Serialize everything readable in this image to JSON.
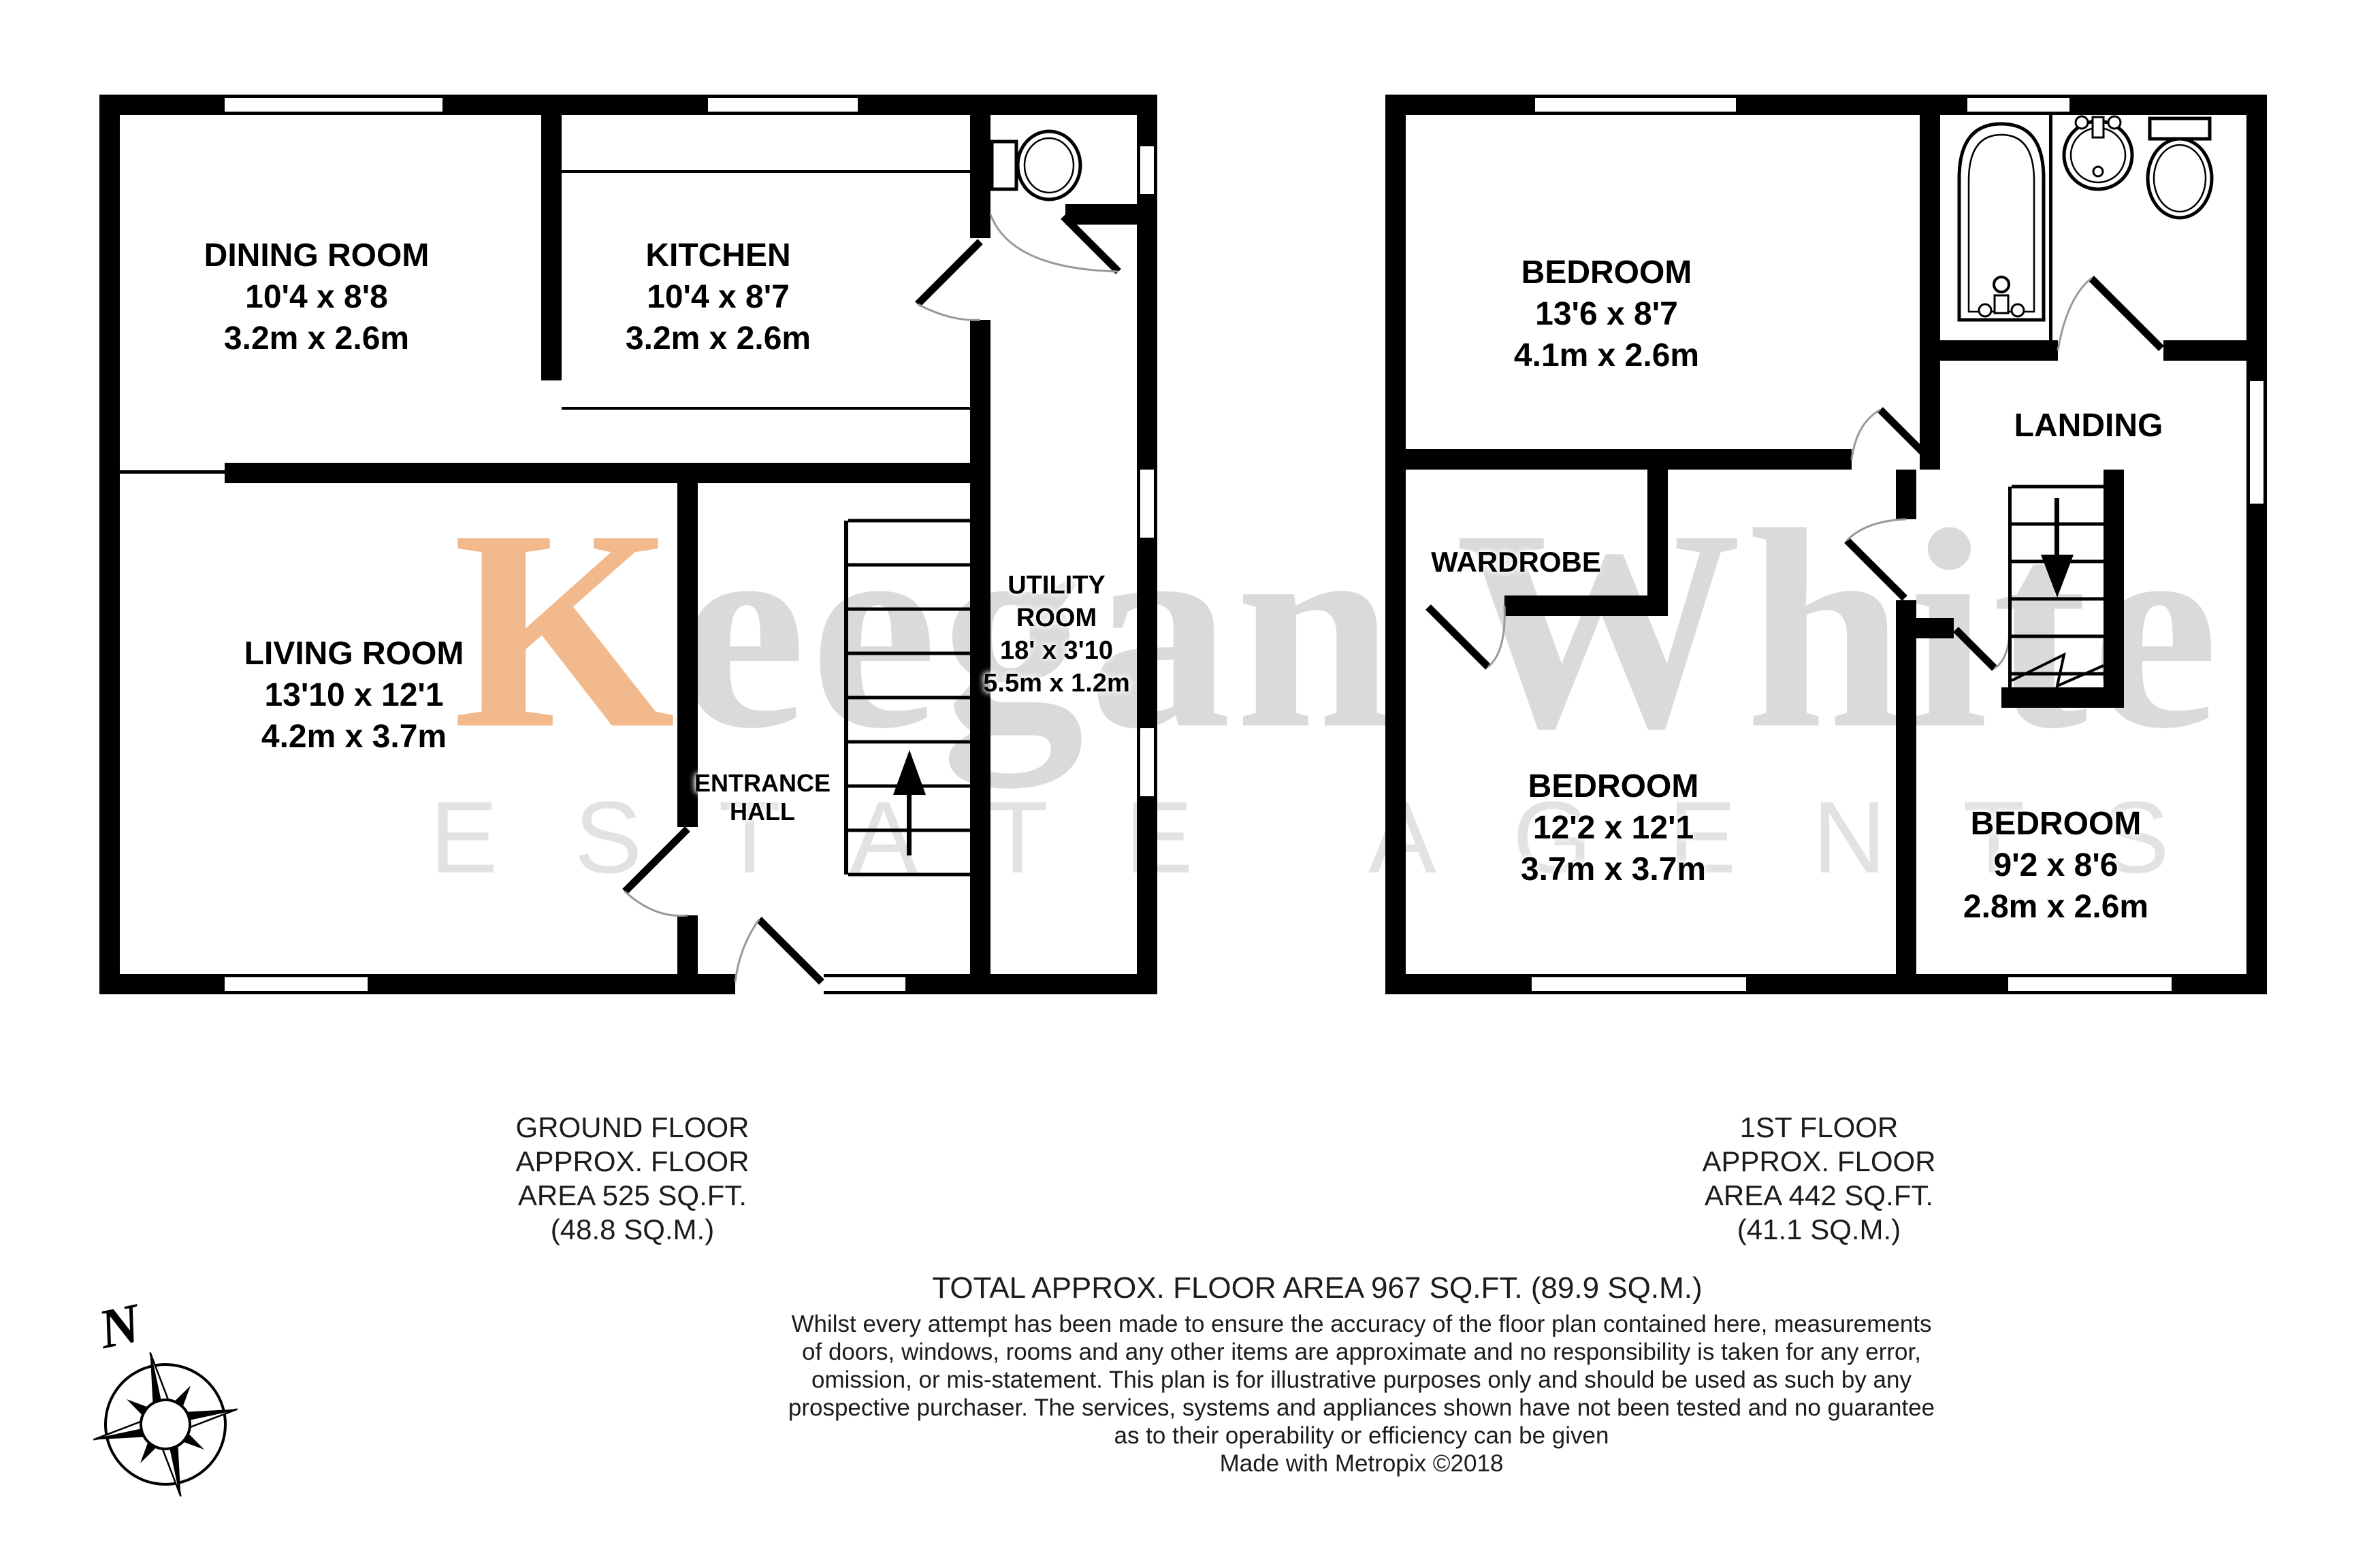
{
  "watermark": {
    "first_letter": "K",
    "first_word_rest": "eegan",
    "second_word": "White",
    "subtitle": "ESTATE AGENTS"
  },
  "ground_floor": {
    "rooms": [
      {
        "name": "DINING ROOM",
        "imperial": "10'4 x 8'8",
        "metric": "3.2m x 2.6m"
      },
      {
        "name": "KITCHEN",
        "imperial": "10'4 x 8'7",
        "metric": "3.2m x 2.6m"
      },
      {
        "name": "LIVING ROOM",
        "imperial": "13'10 x 12'1",
        "metric": "4.2m x 3.7m"
      }
    ],
    "utility": {
      "name_line1": "UTILITY",
      "name_line2": "ROOM",
      "imperial": "18' x 3'10",
      "metric": "5.5m x 1.2m"
    },
    "hall": {
      "line1": "ENTRANCE",
      "line2": "HALL"
    },
    "caption": [
      "GROUND FLOOR",
      "APPROX. FLOOR",
      "AREA 525 SQ.FT.",
      "(48.8 SQ.M.)"
    ]
  },
  "first_floor": {
    "rooms": [
      {
        "name": "BEDROOM",
        "imperial": "13'6 x 8'7",
        "metric": "4.1m x 2.6m"
      },
      {
        "name": "BEDROOM",
        "imperial": "12'2 x 12'1",
        "metric": "3.7m x 3.7m"
      },
      {
        "name": "BEDROOM",
        "imperial": "9'2 x 8'6",
        "metric": "2.8m x 2.6m"
      }
    ],
    "landing": "LANDING",
    "wardrobe": "WARDROBE",
    "caption": [
      "1ST FLOOR",
      "APPROX. FLOOR",
      "AREA 442 SQ.FT.",
      "(41.1 SQ.M.)"
    ]
  },
  "footer": {
    "total": "TOTAL APPROX. FLOOR AREA 967 SQ.FT. (89.9 SQ.M.)",
    "disclaimer": [
      "Whilst every attempt has been made to ensure the accuracy of the floor plan contained here, measurements",
      "of doors, windows, rooms and any other items are approximate and no responsibility is taken for any error,",
      "omission, or mis-statement. This plan is for illustrative purposes only and should be used as such by any",
      "prospective purchaser. The services, systems and appliances shown have not been tested and no guarantee",
      "as to their operability or efficiency can be given"
    ],
    "credit": "Made with Metropix ©2018"
  },
  "compass": {
    "north": "N"
  }
}
